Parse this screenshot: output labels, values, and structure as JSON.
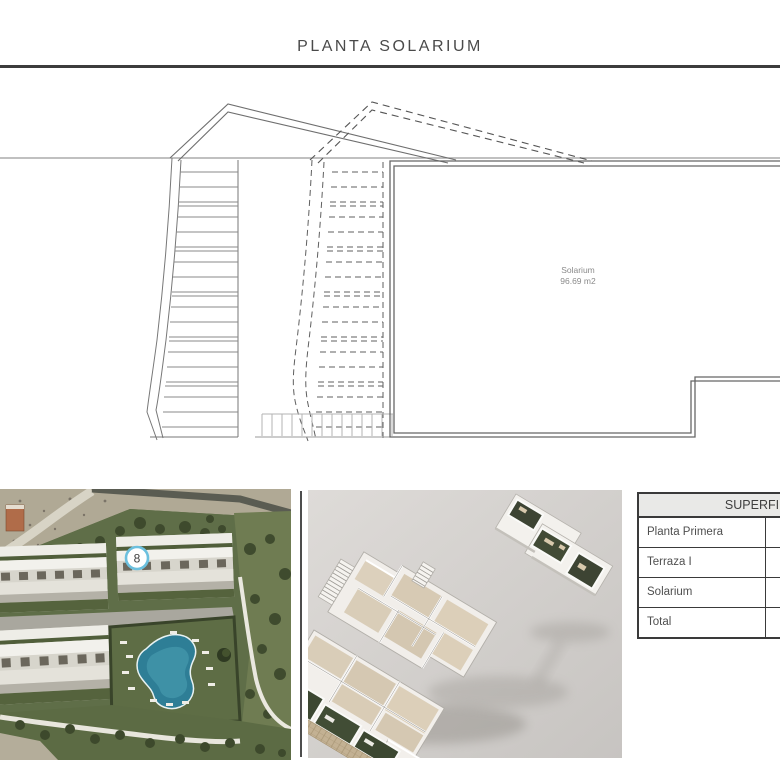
{
  "page": {
    "title": "PLANTA SOLARIUM"
  },
  "plan": {
    "room_label": "Solarium",
    "room_area": "96.69 m2"
  },
  "photo": {
    "unit_marker": "8"
  },
  "table": {
    "header": "SUPERFI",
    "rows": [
      "Planta Primera",
      "Terraza I",
      "Solarium",
      "Total"
    ]
  },
  "colors": {
    "title_text": "#4a4a4a",
    "rule": "#3c3c3c",
    "plan_solid_line": "#6e6e6e",
    "plan_dashed_line": "#555555",
    "plan_aux_gray": "#9a9a9a",
    "marker_ring": "#6cc0de",
    "pool_water": "#2e7e96",
    "garden_green": "#3c4731",
    "render_background": "#d3d0cd",
    "table_header_bg": "#e9e9e7",
    "table_border": "#3a3a3a"
  }
}
